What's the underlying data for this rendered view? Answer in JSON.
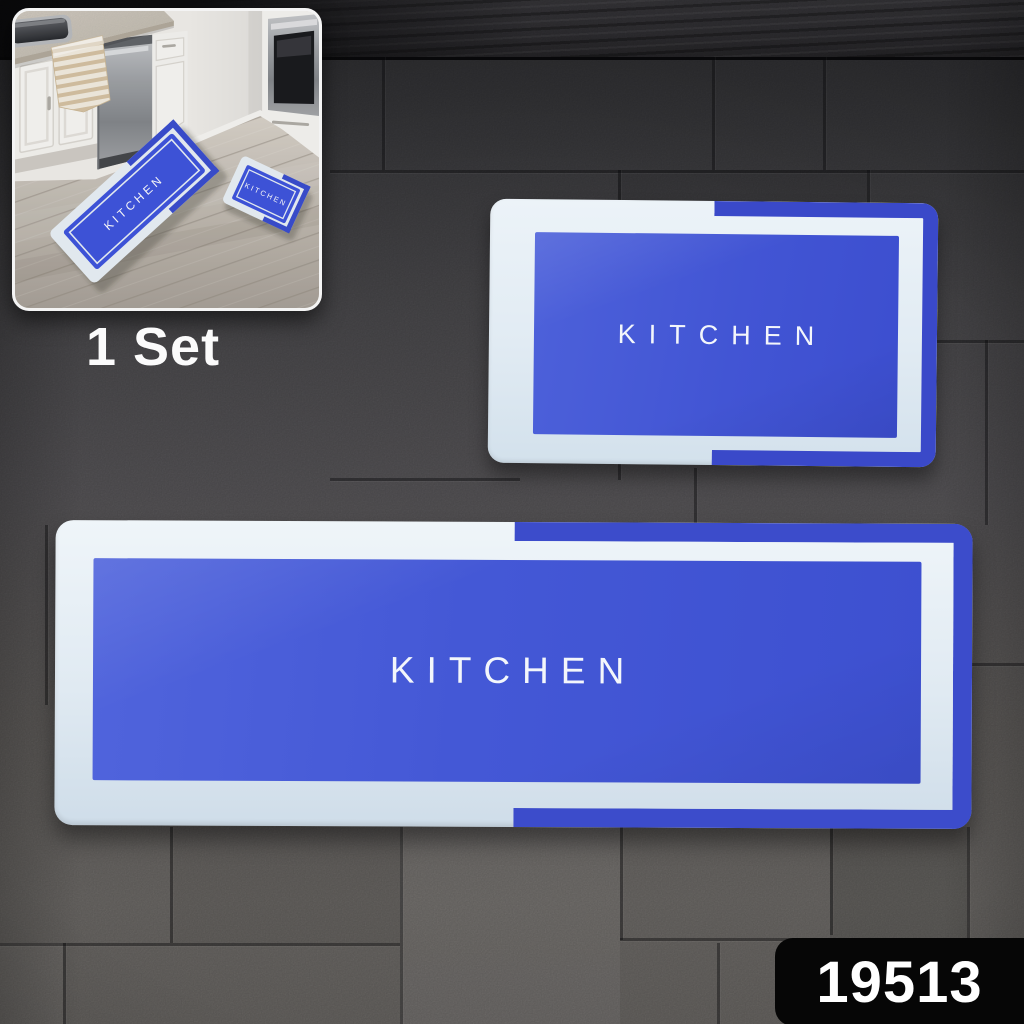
{
  "product": {
    "code": "19513",
    "set_label": "1 Set"
  },
  "mats": {
    "small_mat_label": "KITCHEN",
    "runner_mat_label": "KITCHEN"
  },
  "inset_photo": {
    "description_runner_label": "KITCHEN",
    "description_small_mat_label": "KITCHEN"
  },
  "colors": {
    "mat_center_blue": "#4458d6",
    "mat_band_blue": "#3a49c9",
    "mat_band_blue_big": "#3c4ccb",
    "mat_border_white": "#e3ecf3",
    "badge_bg": "#060606",
    "badge_text": "#ffffff",
    "tile_gray_dark": "#39393c",
    "tile_gray_light": "#6f6c69"
  }
}
